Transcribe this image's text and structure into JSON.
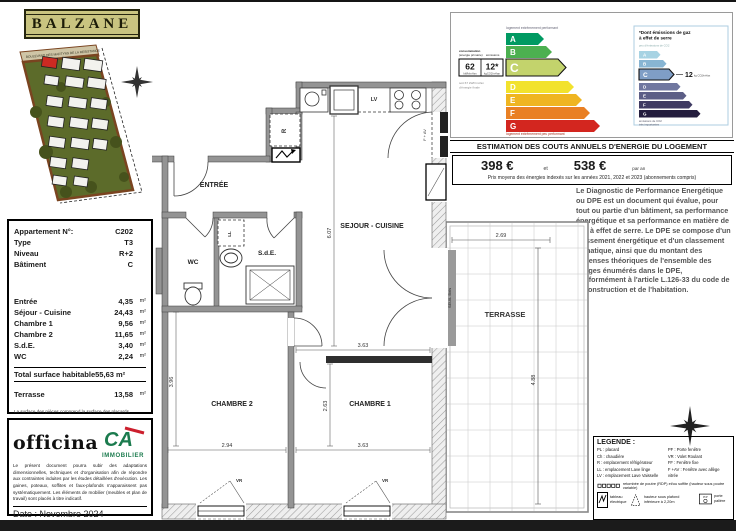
{
  "project": {
    "title": "BALZANE",
    "street": "BOULEVARD DES MARTYRS DE LA RESISTANCE"
  },
  "info": {
    "header_rows": [
      {
        "label": "Appartement N°:",
        "value": "C202"
      },
      {
        "label": "Type",
        "value": "T3"
      },
      {
        "label": "Niveau",
        "value": "R+2"
      },
      {
        "label": "Bâtiment",
        "value": "C"
      }
    ],
    "area_rows": [
      {
        "label": "Entrée",
        "value": "4,35",
        "unit": "m²"
      },
      {
        "label": "Séjour - Cuisine",
        "value": "24,43",
        "unit": "m²"
      },
      {
        "label": "Chambre 1",
        "value": "9,56",
        "unit": "m²"
      },
      {
        "label": "Chambre 2",
        "value": "11,65",
        "unit": "m²"
      },
      {
        "label": "S.d.E.",
        "value": "3,40",
        "unit": "m²"
      },
      {
        "label": "WC",
        "value": "2,24",
        "unit": "m²"
      }
    ],
    "total_label": "Total surface habitable",
    "total_value": "55,63 m²",
    "terrace_row": {
      "label": "Terrasse",
      "value": "13,58",
      "unit": "m²"
    },
    "note": "La surface des pièces comprend la surface des placards."
  },
  "branding": {
    "officina": "officina",
    "ca_monogram": "CA",
    "ca_name": "IMMOBILIER",
    "disclaimer": "Le présent document pourra subir des adaptations dimensionnelles, techniques et d'organisation afin de répondre aux contraintes induites par les études détaillées d'exécution. Les gaines, poteaux, soffites et faux-plafonds n'apparaissent pas systématiquement. Les éléments de mobilier (meubles et plan de travail) sont placés à titre indicatif.",
    "date": "Date : Novembre 2024"
  },
  "dpe": {
    "caption_top": "logement extrêmement performant",
    "caption_bottom": "logement extrêmement peu performant",
    "selected": "C",
    "energy_classes": [
      {
        "letter": "A",
        "color": "#009a62"
      },
      {
        "letter": "B",
        "color": "#4cb050"
      },
      {
        "letter": "C",
        "color": "#c3d36c"
      },
      {
        "letter": "D",
        "color": "#f2e22d"
      },
      {
        "letter": "E",
        "color": "#efb521"
      },
      {
        "letter": "F",
        "color": "#e98024"
      },
      {
        "letter": "G",
        "color": "#d3261f"
      }
    ],
    "conso_header_1": "consommation",
    "conso_header_2": "(énergie primaire)",
    "conso_header_3": "émissions",
    "conso_value": "62",
    "conso_unit": "kWh/m²/an",
    "emission_value": "12*",
    "emission_unit": "kgCO2/m²/an",
    "final_energy_1": "soit 67 kWh/m²/an",
    "final_energy_2": "d'énergie finale",
    "ges": {
      "title_1": "*Dont émissions de gaz",
      "title_2": "à effet de serre",
      "caption_top": "peu d'émissions de CO2",
      "value": "12",
      "unit": "kg CO2/m²/an",
      "caption_bottom_1": "émissions de CO2",
      "caption_bottom_2": "très importantes",
      "classes": [
        {
          "letter": "A",
          "color": "#a7d3e3"
        },
        {
          "letter": "B",
          "color": "#88b5d3"
        },
        {
          "letter": "C",
          "color": "#7f9ec6"
        },
        {
          "letter": "D",
          "color": "#70779f"
        },
        {
          "letter": "E",
          "color": "#5c5e86"
        },
        {
          "letter": "F",
          "color": "#3f3a63"
        },
        {
          "letter": "G",
          "color": "#241d3e"
        }
      ]
    }
  },
  "costs": {
    "header": "ESTIMATION DES COUTS ANNUELS D'ENERGIE DU LOGEMENT",
    "value_min": "398 €",
    "separator": "et",
    "value_max": "538 €",
    "suffix": "par an",
    "footnote": "Prix moyens des énergies indexés sur les années 2021, 2022 et 2023 (abonnements compris)"
  },
  "dpe_description": "Le Diagnostic de Performance Energétique ou DPE est un document qui évalue, pour tout ou partie d'un bâtiment, sa performance énergétique et sa performance en matière de gaz à effet de serre. Le DPE se compose d'un classement énergétique et d'un classement climatique, ainsi que du montant des dépenses théoriques de l'ensemble des usages énumérés dans le DPE, conformément à l'article L.126-33 du code de la construction et de l'habitation.",
  "plan": {
    "rooms": {
      "entree": "ENTRÉE",
      "wc": "WC",
      "sde": "S.d.E.",
      "sejour": "SEJOUR - CUISINE",
      "chambre1": "CHAMBRE 1",
      "chambre2": "CHAMBRE 2",
      "terrasse": "TERRASSE"
    },
    "labels": {
      "lv": "LV",
      "r": "R",
      "ll": "LL",
      "vr": "VR",
      "fav": "F + AV",
      "seuil": "SEUIL Bois"
    },
    "dims": {
      "sejour_h": "6.07",
      "ch1_top": "3.63",
      "ch1_h": "2.63",
      "ch2_left": "3.96",
      "ch2_w": "2.94",
      "ch1_w": "3.63",
      "ter_w": "2.69",
      "ter_h": "4.88"
    }
  },
  "legend": {
    "title": "LEGENDE :",
    "left_items": [
      "PL : placard",
      "Ch : chaudière",
      "R : emplacement réfrigérateur",
      "LL : emplacement Lave linge",
      "LV : emplacement Lave Vaisselle"
    ],
    "right_items": [
      "PF : Porte fenêtre",
      "VR : Volet Roulant",
      "FF : Fenêtre fixe",
      "F +AV : Fenêtre avec allège vitrée"
    ],
    "beam_note": "retombée de poutre (RDP) et/ou soffite (hauteur sous poutre variable)",
    "electrical_1": "tableau",
    "electrical_2": "électrique",
    "ceiling_note": "hauteur sous plafond inférieure à 2,20m",
    "pp_abbr": "P.P",
    "pp_label": "porte palière"
  }
}
